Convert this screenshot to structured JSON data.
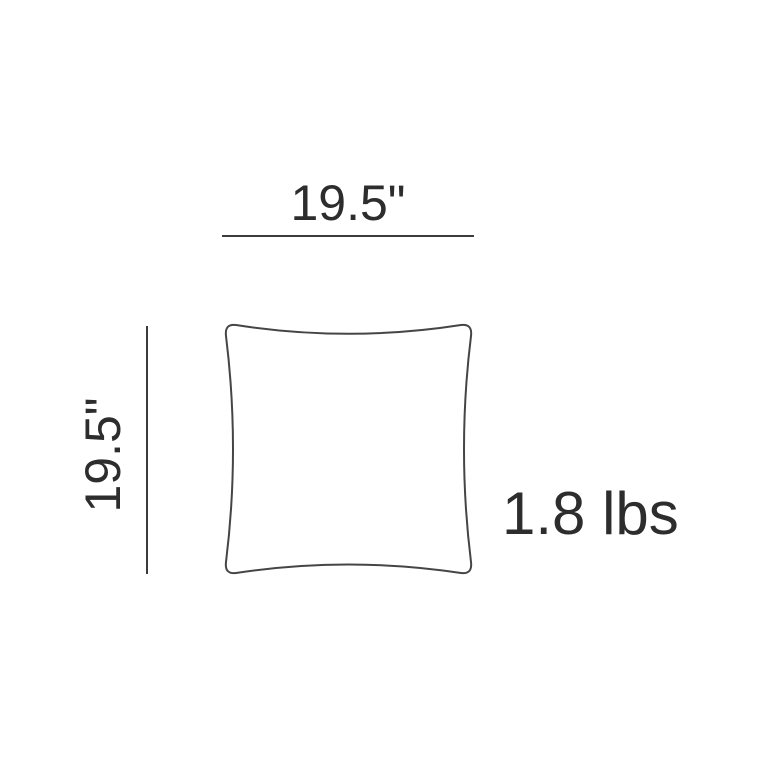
{
  "diagram": {
    "kind": "product-dimension-diagram",
    "subject": "square-pillow-outline",
    "width_dimension": "19.5\"",
    "height_dimension": "19.5\"",
    "weight": "1.8 lbs",
    "colors": {
      "background": "#ffffff",
      "text": "#2d2d2d",
      "dimension_line": "#3b3b3b",
      "pillow_outline": "#454545"
    }
  }
}
